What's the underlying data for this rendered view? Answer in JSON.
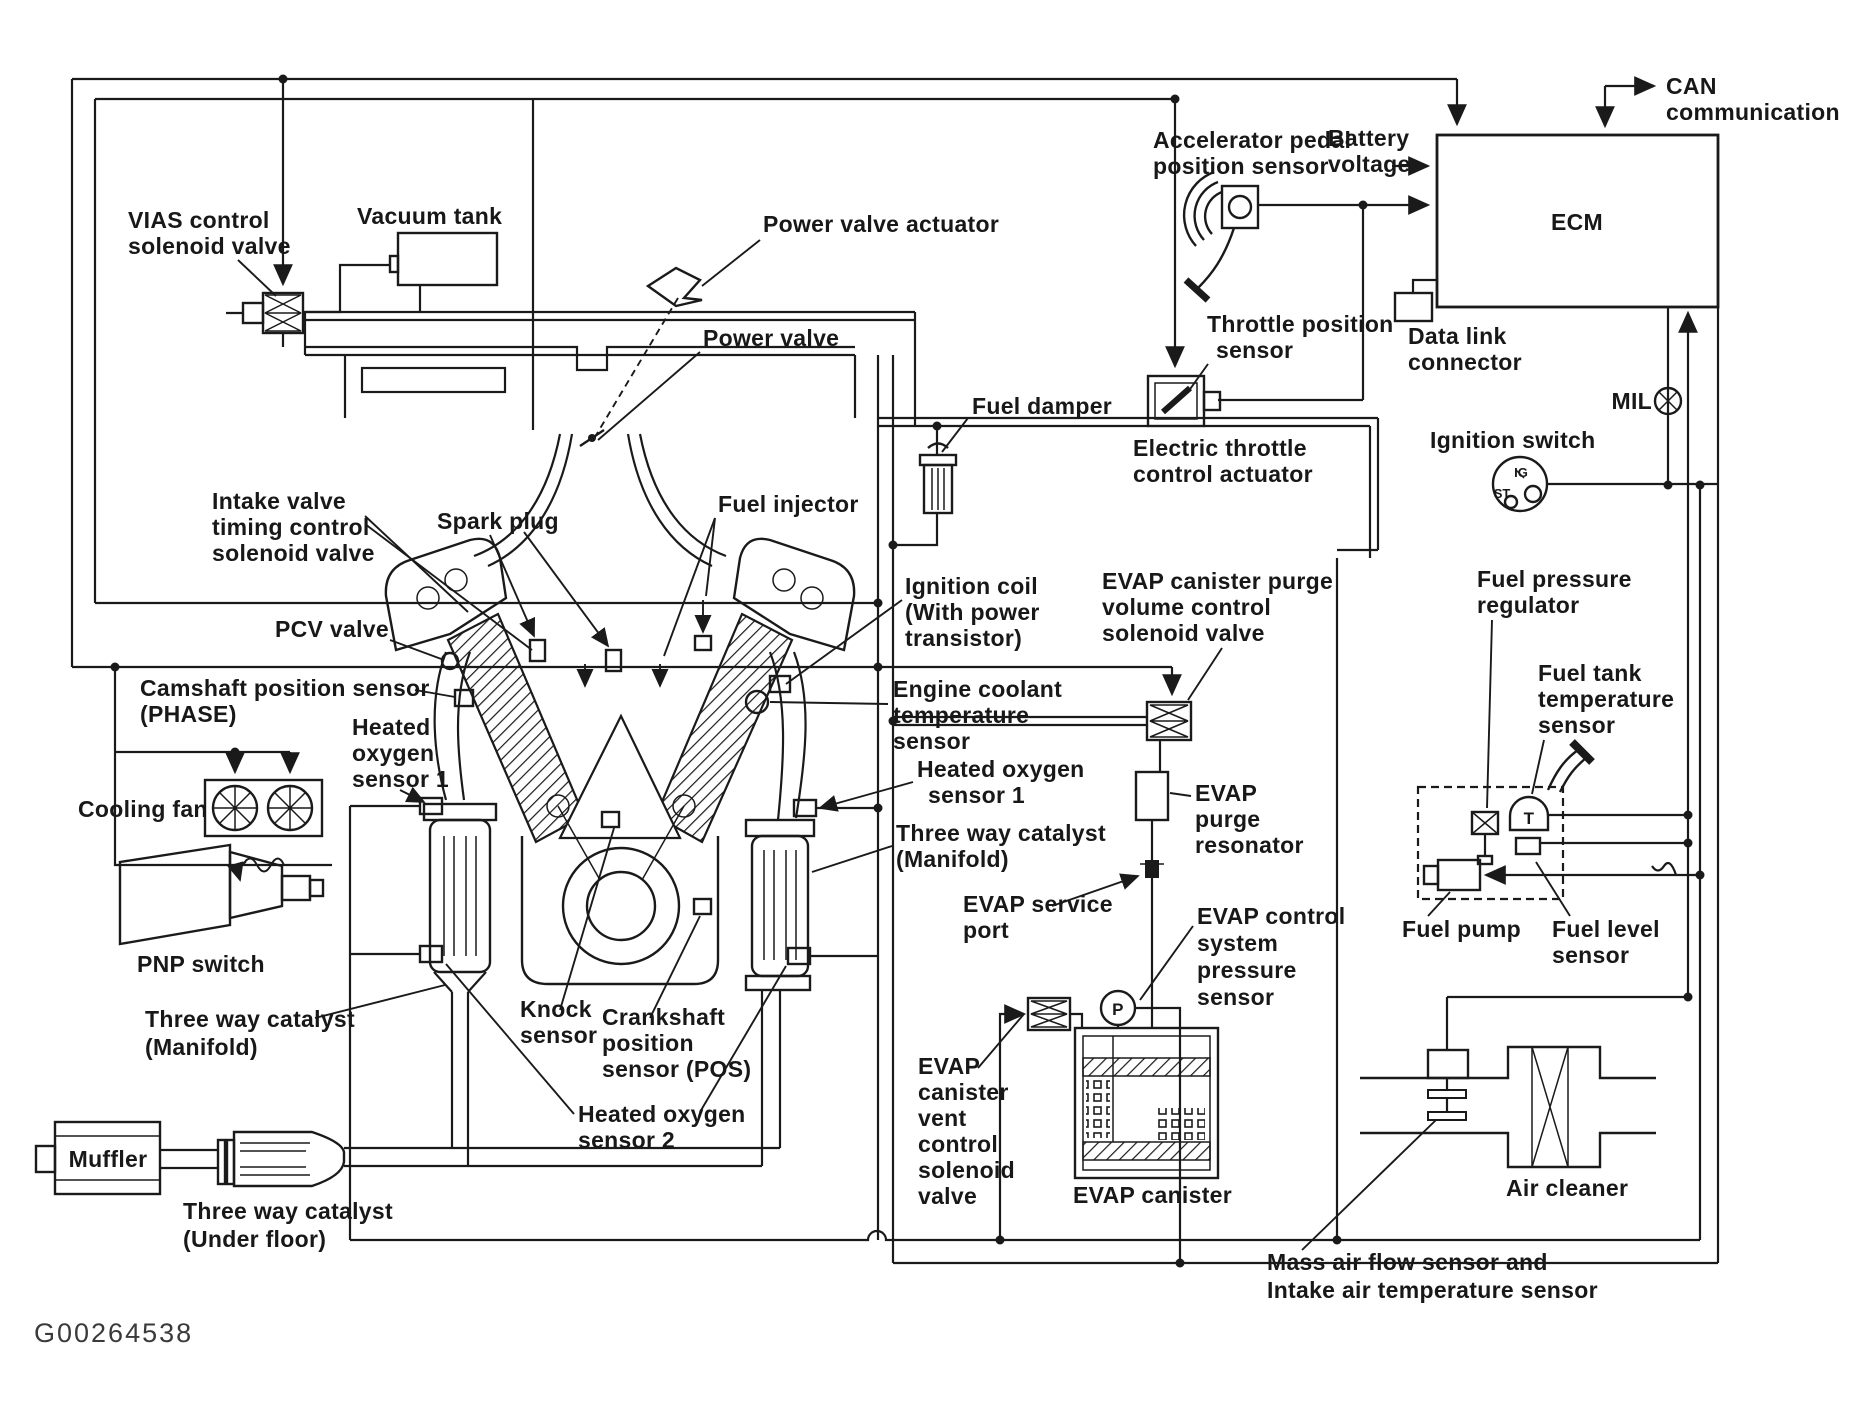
{
  "figure_id": "G00264538",
  "colors": {
    "ink": "#1a1a1a",
    "paper": "#ffffff"
  },
  "labels": {
    "vias": [
      "VIAS control",
      "solenoid valve"
    ],
    "vacuum_tank": [
      "Vacuum tank"
    ],
    "power_valve_actuator": [
      "Power valve actuator"
    ],
    "power_valve": [
      "Power valve"
    ],
    "fuel_damper": [
      "Fuel damper"
    ],
    "accelerator_pedal": [
      "Accelerator pedal",
      "position sensor"
    ],
    "battery": [
      "Battery",
      "voltage"
    ],
    "ecm": [
      "ECM"
    ],
    "can": [
      "CAN",
      "communication"
    ],
    "data_link": [
      "Data link",
      "connector"
    ],
    "mil": [
      "MIL"
    ],
    "ignition_switch": [
      "Ignition switch"
    ],
    "ignition_marks": {
      "ig": "IG",
      "st": "ST"
    },
    "throttle_position": [
      "Throttle position",
      "sensor"
    ],
    "electric_throttle": [
      "Electric throttle",
      "control actuator"
    ],
    "intake_valve": [
      "Intake valve",
      "timing control",
      "solenoid valve"
    ],
    "spark_plug": [
      "Spark plug"
    ],
    "fuel_injector": [
      "Fuel injector"
    ],
    "ignition_coil": [
      "Ignition coil",
      "(With power",
      "transistor)"
    ],
    "pcv_valve": [
      "PCV valve"
    ],
    "camshaft": [
      "Camshaft position sensor",
      "(PHASE)"
    ],
    "cooling_fan": [
      "Cooling fan"
    ],
    "pnp_switch": [
      "PNP switch"
    ],
    "ho2s1_left": [
      "Heated",
      "oxygen",
      "sensor 1"
    ],
    "engine_coolant": [
      "Engine coolant",
      "temperature",
      "sensor"
    ],
    "ho2s1_right": [
      "Heated oxygen",
      "sensor 1"
    ],
    "twc_manifold_right": [
      "Three way catalyst",
      "(Manifold)"
    ],
    "twc_manifold_left": [
      "Three way catalyst",
      "(Manifold)"
    ],
    "knock_sensor": [
      "Knock",
      "sensor"
    ],
    "crankshaft": [
      "Crankshaft",
      "position",
      "sensor (POS)"
    ],
    "ho2s2": [
      "Heated oxygen",
      "sensor 2"
    ],
    "muffler": [
      "Muffler"
    ],
    "twc_under_floor": [
      "Three way catalyst",
      "(Under floor)"
    ],
    "evap_purge_valve": [
      "EVAP canister purge",
      "volume control",
      "solenoid valve"
    ],
    "evap_purge_resonator": [
      "EVAP",
      "purge",
      "resonator"
    ],
    "evap_service_port": [
      "EVAP service",
      "port"
    ],
    "evap_pressure_sensor": [
      "EVAP control",
      "system",
      "pressure",
      "sensor"
    ],
    "evap_vent_valve": [
      "EVAP",
      "canister",
      "vent",
      "control",
      "solenoid",
      "valve"
    ],
    "evap_canister": [
      "EVAP canister"
    ],
    "fuel_pressure_regulator": [
      "Fuel pressure",
      "regulator"
    ],
    "fuel_tank_temp": [
      "Fuel tank",
      "temperature",
      "sensor"
    ],
    "fuel_pump": [
      "Fuel pump"
    ],
    "fuel_level": [
      "Fuel level",
      "sensor"
    ],
    "air_cleaner": [
      "Air cleaner"
    ],
    "maf": [
      "Mass air flow sensor and",
      "Intake air temperature sensor"
    ],
    "sensor_marks": {
      "t": "T",
      "p": "P"
    }
  }
}
